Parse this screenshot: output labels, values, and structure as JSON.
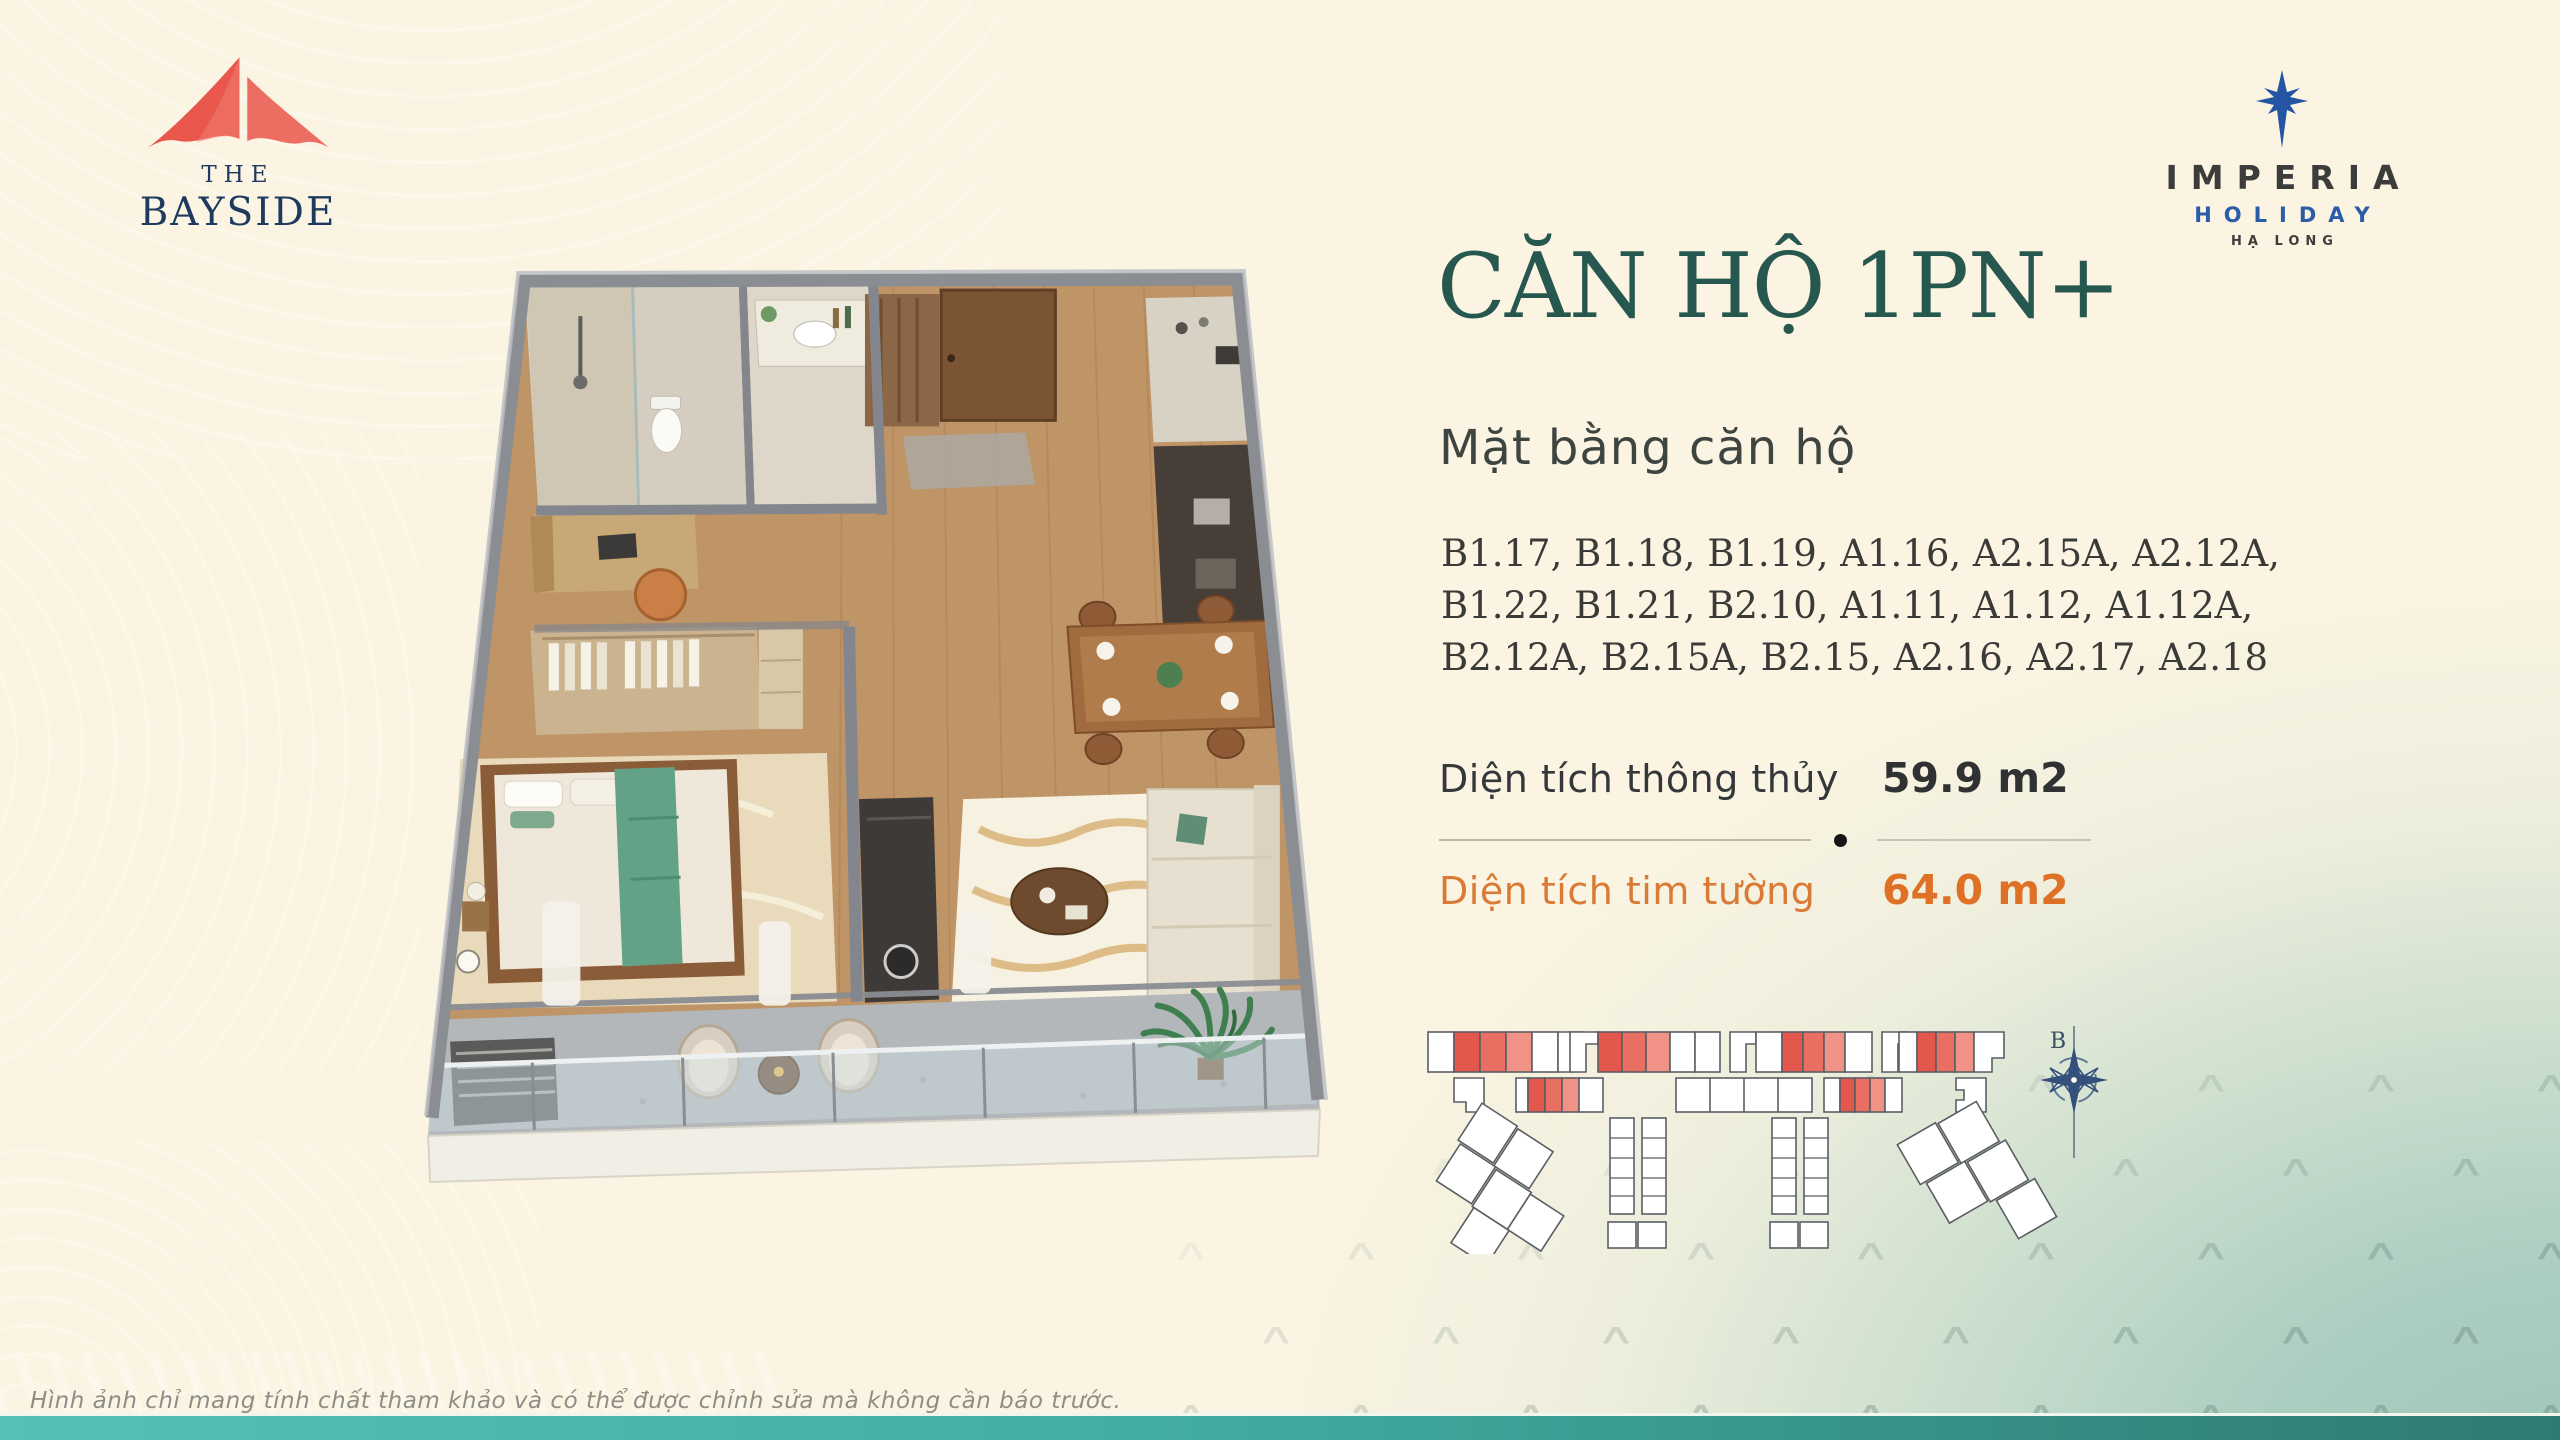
{
  "brand_left": {
    "the": "THE",
    "name": "BAYSIDE"
  },
  "brand_right": {
    "name": "IMPERIA",
    "line2": "HOLIDAY",
    "line3": "HẠ LONG"
  },
  "content": {
    "title": "CĂN HỘ 1PN+",
    "subtitle": "Mặt bằng căn hộ",
    "unit_lines": [
      "B1.17, B1.18, B1.19, A1.16, A2.15A, A2.12A,",
      "B1.22, B1.21, B2.10, A1.11, A1.12, A1.12A,",
      "B2.12A, B2.15A, B2.15, A2.16, A2.17, A2.18"
    ],
    "areas": {
      "row1_label": "Diện tích thông thủy",
      "row1_value": "59.9 m2",
      "row2_label": "Diện tích tim tường",
      "row2_value": "64.0 m2"
    },
    "compass_label": "B"
  },
  "footer": {
    "disclaimer": "Hình ảnh chỉ mang tính chất tham khảo và có thể được chỉnh sửa mà không cần báo trước."
  },
  "colors": {
    "title_teal": "#27584f",
    "accent_orange": "#df7126",
    "highlight_red": "#e4574c",
    "brand_navy": "#1e3a5f",
    "imperia_blue": "#2b5ca8",
    "background_cream": "#fbf4e2",
    "background_teal": "#9cc4b8",
    "footer_teal_left": "#55c1b6",
    "footer_teal_right": "#2e7b71"
  }
}
